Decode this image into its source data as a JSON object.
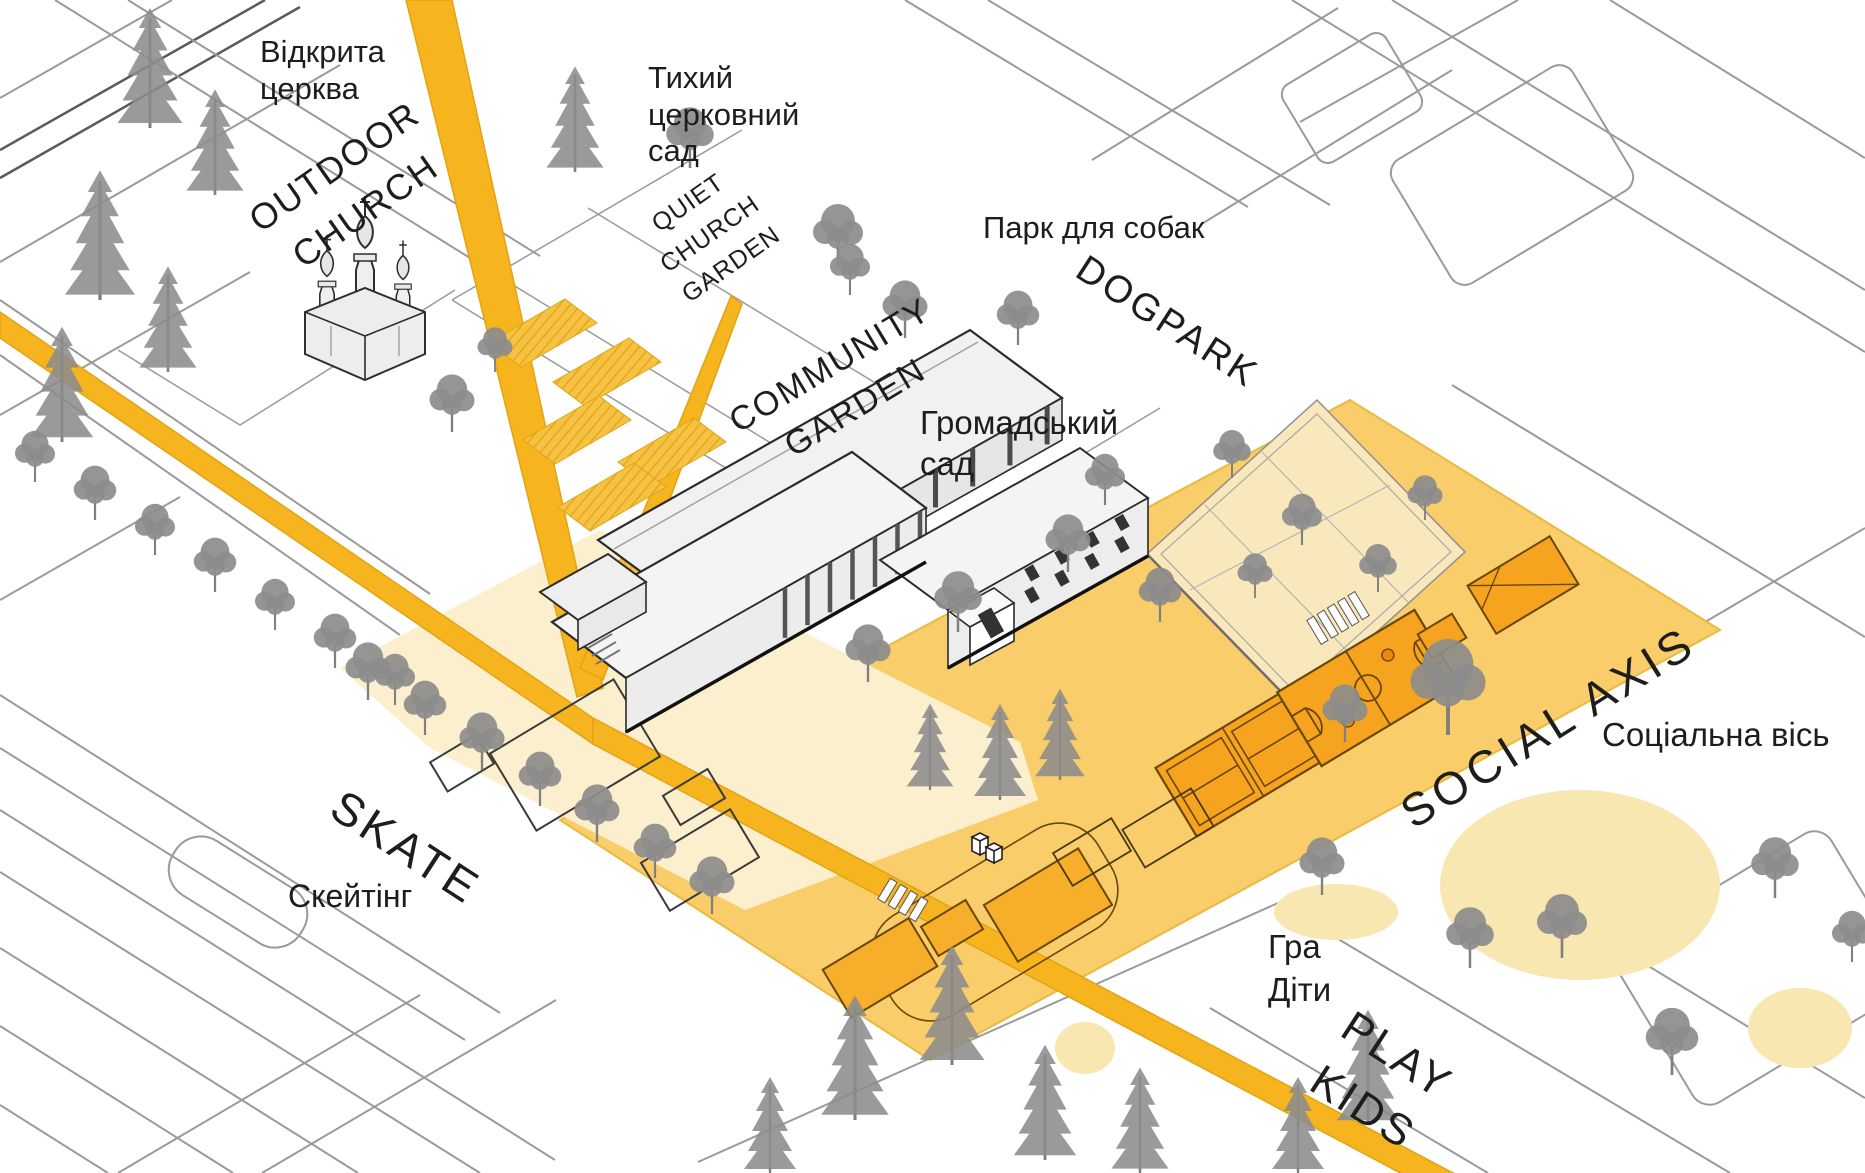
{
  "diagram": {
    "title": "Axonometric park / site concept plan",
    "labels": {
      "outdoor_church": {
        "uk": "Відкрита\nцерква",
        "en": "OUTDOOR\nCHURCH"
      },
      "quiet_church_garden": {
        "uk": "Тихий\nцерковний\nсад",
        "en": "QUIET\nCHURCH\nGARDEN"
      },
      "dogpark": {
        "uk": "Парк для собак",
        "en": "DOGPARK"
      },
      "community_garden": {
        "uk": "Громадський\nсад",
        "en": "COMMUNITY\nGARDEN"
      },
      "social_axis": {
        "uk": "Соціальна вісь",
        "en": "SOCIAL AXIS"
      },
      "skate": {
        "uk": "Скейтінг",
        "en": "SKATE"
      },
      "play_kids": {
        "uk": "Гра\nДіти",
        "en": "PLAY\nKIDS"
      }
    },
    "colors": {
      "background": "#FFFFFF",
      "road_yellow": "#F6B41E",
      "axis_band_yellow": "#F8CD6A",
      "pale_plaza_yellow": "#FBEFCE",
      "dogpark_pale": "#F9E8BC",
      "garden_plot_yellow": "#F5C243",
      "court_orange": "#F6A41F",
      "court_outline_brown": "#6B4708",
      "play_blob_yellow": "#F8E7B0",
      "building_gray": "#F1F1F1",
      "tree_gray": "#8C8C8C",
      "street_line_gray": "#9A9A9A",
      "ink": "#1D1D1B"
    }
  }
}
